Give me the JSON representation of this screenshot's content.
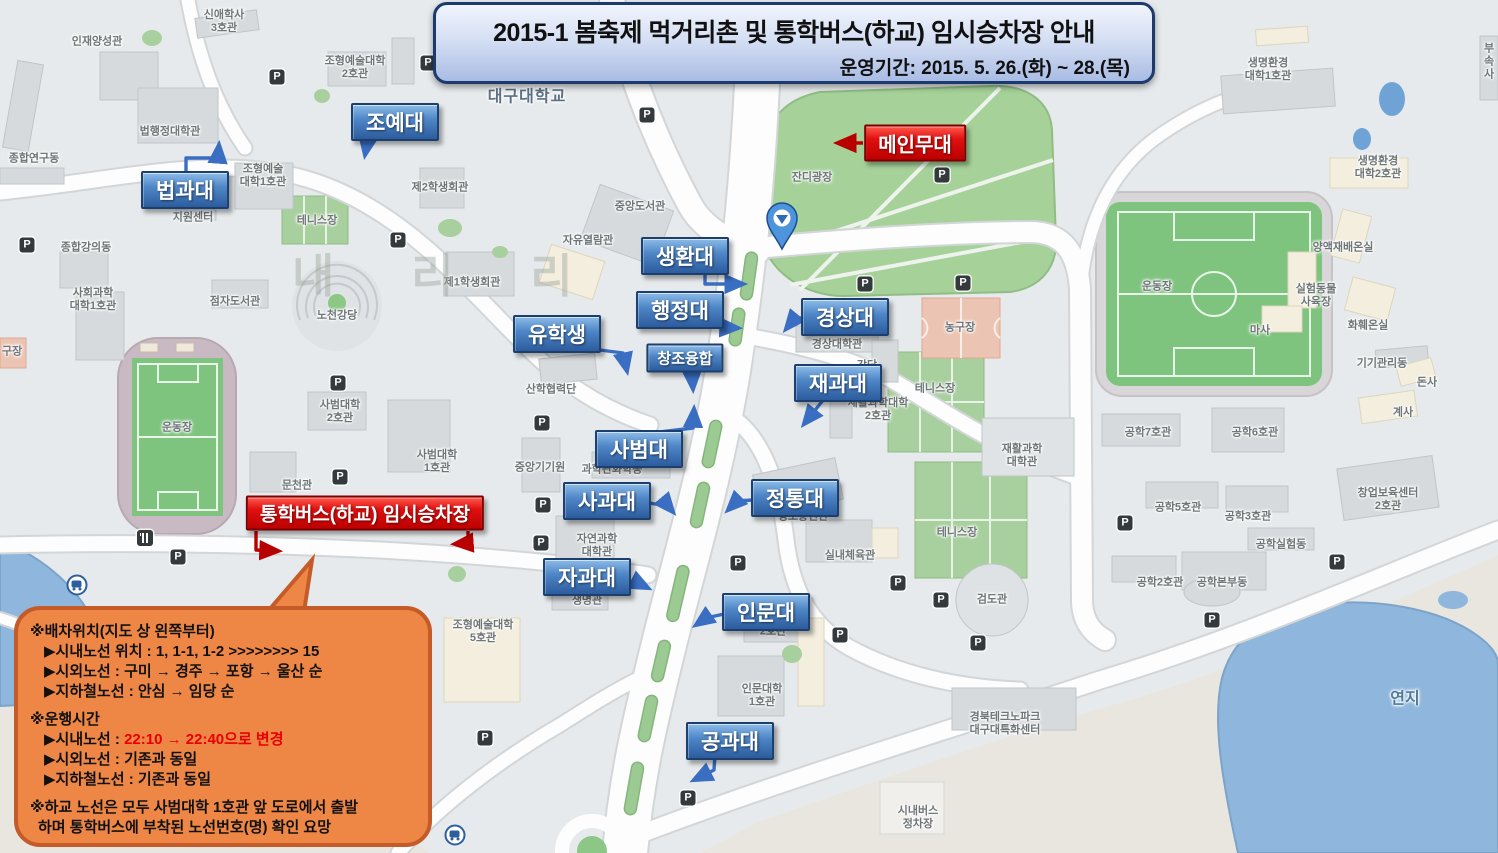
{
  "banner": {
    "title": "2015-1 봄축제 먹거리촌 및 통학버스(하교) 임시승차장 안내",
    "subtitle": "운영기간: 2015. 5. 26.(화) ~ 28.(목)"
  },
  "colors": {
    "label_blue": "#3f76b8",
    "label_red": "#cc0000",
    "bubble_orange": "#ee8746",
    "banner_blue": "#c9d6ef",
    "grass_green": "#a6d29a",
    "pond_blue": "#8fb6dc"
  },
  "map": {
    "campus_name": "대구대학교",
    "watermark": "내 리 리",
    "stage_label": {
      "text": "메인무대",
      "x": 915,
      "y": 143
    },
    "bus_label": {
      "text": "통학버스(하교) 임시승차장",
      "x": 365,
      "y": 513
    },
    "college_labels": [
      {
        "text": "조예대",
        "x": 395,
        "y": 122
      },
      {
        "text": "법과대",
        "x": 185,
        "y": 190
      },
      {
        "text": "생환대",
        "x": 685,
        "y": 256
      },
      {
        "text": "행정대",
        "x": 680,
        "y": 310
      },
      {
        "text": "경상대",
        "x": 845,
        "y": 317
      },
      {
        "text": "유학생",
        "x": 557,
        "y": 334
      },
      {
        "text": "창조융합",
        "x": 685,
        "y": 358,
        "small": true
      },
      {
        "text": "재과대",
        "x": 838,
        "y": 383
      },
      {
        "text": "사범대",
        "x": 639,
        "y": 449
      },
      {
        "text": "사과대",
        "x": 607,
        "y": 501
      },
      {
        "text": "정통대",
        "x": 795,
        "y": 498
      },
      {
        "text": "자과대",
        "x": 587,
        "y": 577
      },
      {
        "text": "인문대",
        "x": 766,
        "y": 612
      },
      {
        "text": "공과대",
        "x": 730,
        "y": 741
      }
    ],
    "building_labels": [
      {
        "text": "신애학사\n3호관",
        "x": 224,
        "y": 22
      },
      {
        "text": "인재양성관",
        "x": 97,
        "y": 42
      },
      {
        "text": "조형예술대학\n2호관",
        "x": 355,
        "y": 68
      },
      {
        "text": "법행정대학관",
        "x": 170,
        "y": 132
      },
      {
        "text": "종합연구동",
        "x": 34,
        "y": 159
      },
      {
        "text": "조형예술\n대학1호관",
        "x": 263,
        "y": 176
      },
      {
        "text": "지원센터",
        "x": 193,
        "y": 218
      },
      {
        "text": "테니스장",
        "x": 317,
        "y": 221
      },
      {
        "text": "제2학생회관",
        "x": 440,
        "y": 188
      },
      {
        "text": "중앙도서관",
        "x": 640,
        "y": 207
      },
      {
        "text": "자유열람관",
        "x": 588,
        "y": 241
      },
      {
        "text": "잔디광장",
        "x": 812,
        "y": 178
      },
      {
        "text": "종합강의동",
        "x": 86,
        "y": 248
      },
      {
        "text": "사회과학\n대학1호관",
        "x": 93,
        "y": 300
      },
      {
        "text": "점자도서관",
        "x": 235,
        "y": 302
      },
      {
        "text": "노천강당",
        "x": 337,
        "y": 316
      },
      {
        "text": "제1학생회관",
        "x": 472,
        "y": 283
      },
      {
        "text": "구장",
        "x": 12,
        "y": 352
      },
      {
        "text": "운동장",
        "x": 177,
        "y": 428
      },
      {
        "text": "경상대학관",
        "x": 837,
        "y": 345
      },
      {
        "text": "강당",
        "x": 867,
        "y": 366
      },
      {
        "text": "농구장",
        "x": 960,
        "y": 328
      },
      {
        "text": "테니스장",
        "x": 935,
        "y": 389
      },
      {
        "text": "재활과학대학\n2호관",
        "x": 878,
        "y": 410
      },
      {
        "text": "재활과학\n대학관",
        "x": 1022,
        "y": 456
      },
      {
        "text": "산학협력단",
        "x": 551,
        "y": 390
      },
      {
        "text": "중앙기기원",
        "x": 540,
        "y": 468
      },
      {
        "text": "과학관화학동",
        "x": 612,
        "y": 470
      },
      {
        "text": "사범대학\n2호관",
        "x": 340,
        "y": 412
      },
      {
        "text": "사범대학\n1호관",
        "x": 437,
        "y": 462
      },
      {
        "text": "문천관",
        "x": 297,
        "y": 486
      },
      {
        "text": "운동장",
        "x": 1157,
        "y": 287
      },
      {
        "text": "자연과학\n대학관",
        "x": 597,
        "y": 546
      },
      {
        "text": "생명관",
        "x": 587,
        "y": 601
      },
      {
        "text": "정보통신관",
        "x": 803,
        "y": 517
      },
      {
        "text": "실내체육관",
        "x": 850,
        "y": 556
      },
      {
        "text": "테니스장",
        "x": 957,
        "y": 533
      },
      {
        "text": "검도관",
        "x": 992,
        "y": 600
      },
      {
        "text": "조형예술대학\n5호관",
        "x": 483,
        "y": 632
      },
      {
        "text": "2호관",
        "x": 773,
        "y": 632
      },
      {
        "text": "인문대학\n1호관",
        "x": 762,
        "y": 696
      },
      {
        "text": "경북테크노파크\n대구대특화센터",
        "x": 1005,
        "y": 724
      },
      {
        "text": "시내버스\n정차장",
        "x": 918,
        "y": 818
      },
      {
        "text": "공학7호관",
        "x": 1148,
        "y": 433
      },
      {
        "text": "공학6호관",
        "x": 1255,
        "y": 433
      },
      {
        "text": "공학5호관",
        "x": 1178,
        "y": 508
      },
      {
        "text": "공학3호관",
        "x": 1248,
        "y": 517
      },
      {
        "text": "공학실험동",
        "x": 1281,
        "y": 545
      },
      {
        "text": "공학2호관",
        "x": 1160,
        "y": 583
      },
      {
        "text": "공학본부동",
        "x": 1222,
        "y": 583
      },
      {
        "text": "창업보육센터\n2호관",
        "x": 1388,
        "y": 500
      },
      {
        "text": "생명환경\n대학1호관",
        "x": 1268,
        "y": 70
      },
      {
        "text": "생명환경\n대학2호관",
        "x": 1378,
        "y": 168
      },
      {
        "text": "양액재배온실",
        "x": 1343,
        "y": 248
      },
      {
        "text": "실험동물\n사육장",
        "x": 1316,
        "y": 296
      },
      {
        "text": "마사",
        "x": 1260,
        "y": 331
      },
      {
        "text": "화훼온실",
        "x": 1368,
        "y": 326
      },
      {
        "text": "기기관리동",
        "x": 1382,
        "y": 364
      },
      {
        "text": "돈사",
        "x": 1427,
        "y": 383
      },
      {
        "text": "계사",
        "x": 1403,
        "y": 413
      },
      {
        "text": "부속\n사",
        "x": 1489,
        "y": 62
      },
      {
        "text": "연지",
        "cls": "water",
        "x": 1405,
        "y": 700
      }
    ],
    "parking_icon": "P",
    "parking_positions": [
      [
        277,
        77
      ],
      [
        428,
        63
      ],
      [
        647,
        115
      ],
      [
        942,
        175
      ],
      [
        27,
        245
      ],
      [
        398,
        240
      ],
      [
        865,
        284
      ],
      [
        963,
        283
      ],
      [
        338,
        383
      ],
      [
        542,
        423
      ],
      [
        340,
        477
      ],
      [
        543,
        505
      ],
      [
        541,
        543
      ],
      [
        178,
        557
      ],
      [
        738,
        563
      ],
      [
        898,
        583
      ],
      [
        941,
        600
      ],
      [
        840,
        635
      ],
      [
        978,
        643
      ],
      [
        485,
        738
      ],
      [
        688,
        798
      ],
      [
        1125,
        523
      ],
      [
        1337,
        562
      ],
      [
        1212,
        620
      ]
    ],
    "bus_stop_positions": [
      [
        77,
        585
      ],
      [
        455,
        835
      ]
    ],
    "restaurant_position": [
      145,
      538
    ]
  },
  "notice": {
    "lines": [
      {
        "text": "※배차위치(지도 상 왼쪽부터)"
      },
      {
        "text": "▶시내노선 위치 : 1, 1-1, 1-2 >>>>>>>> 15",
        "ind": true
      },
      {
        "text": "▶시외노선 : 구미 → 경주 → 포항 → 울산 순",
        "ind": true
      },
      {
        "text": "▶지하철노선 : 안심 → 임당 순",
        "ind": true,
        "gap": true
      },
      {
        "text": "※운행시간"
      },
      {
        "pre": "▶시내노선 : ",
        "red": "22:10 → 22:40으로 변경",
        "ind": true
      },
      {
        "text": "▶시외노선 : 기존과 동일",
        "ind": true
      },
      {
        "text": "▶지하철노선 : 기존과 동일",
        "ind": true,
        "gap": true
      },
      {
        "text": "※하교 노선은 모두 사범대학 1호관 앞 도로에서 출발"
      },
      {
        "text": "하며 통학버스에 부착된 노선번호(명) 확인 요망",
        "hang": true
      }
    ]
  }
}
